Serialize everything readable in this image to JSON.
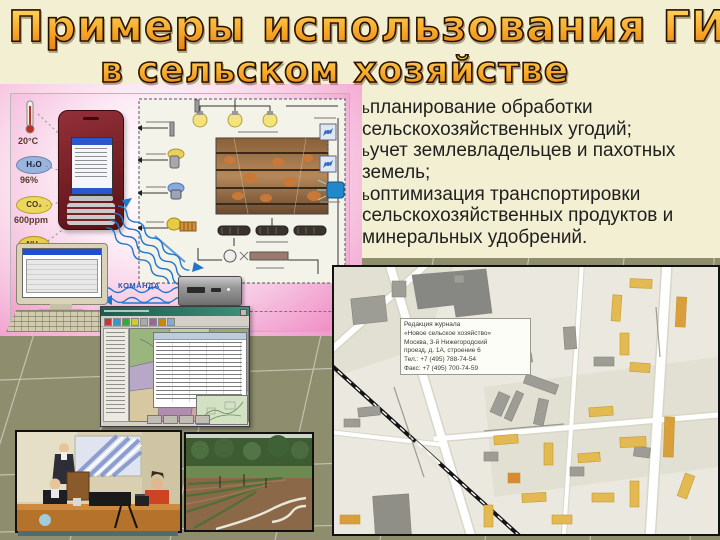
{
  "slide": {
    "title_line1": "Примеры использования ГИС",
    "title_line2": "в сельском хозяйстве"
  },
  "bullets": {
    "marker": "ь",
    "items": [
      "планирование обработки сельскохозяйственных угодий;",
      "учет землевладельцев и пахотных земель;",
      "оптимизация транспортировки сельскохозяйственных продуктов и минеральных удобрений."
    ]
  },
  "diagram": {
    "command_label": "КОМАНДА",
    "sensors": [
      {
        "icon": "thermometer-icon",
        "value": "20°C"
      },
      {
        "icon": "humidity-cloud-icon",
        "formula": "H₂O",
        "value": "96%"
      },
      {
        "icon": "co2-cloud-icon",
        "formula": "CO₂",
        "value": "600ppm"
      },
      {
        "icon": "nh3-cloud-icon",
        "formula": "NH₃",
        "value": "20мг"
      }
    ]
  },
  "map": {
    "info_lines": [
      "Редакция журнала",
      "«Новое сельское хозяйство»",
      "Москва, 3-й Нижегородский",
      "проезд, д. 1А, строение 6",
      "Тел.: +7 (495) 788-74-54",
      "Факс: +7 (495) 700-74-59"
    ]
  },
  "colors": {
    "title_orange": "#f8ab2c",
    "slide_cream": "#f2efd3",
    "olive_background": "#8e8e6e",
    "diagram_pink": "#ef86c4",
    "map_building_yellow": "#e3ba52",
    "signal_blue": "#1a5ab8"
  }
}
